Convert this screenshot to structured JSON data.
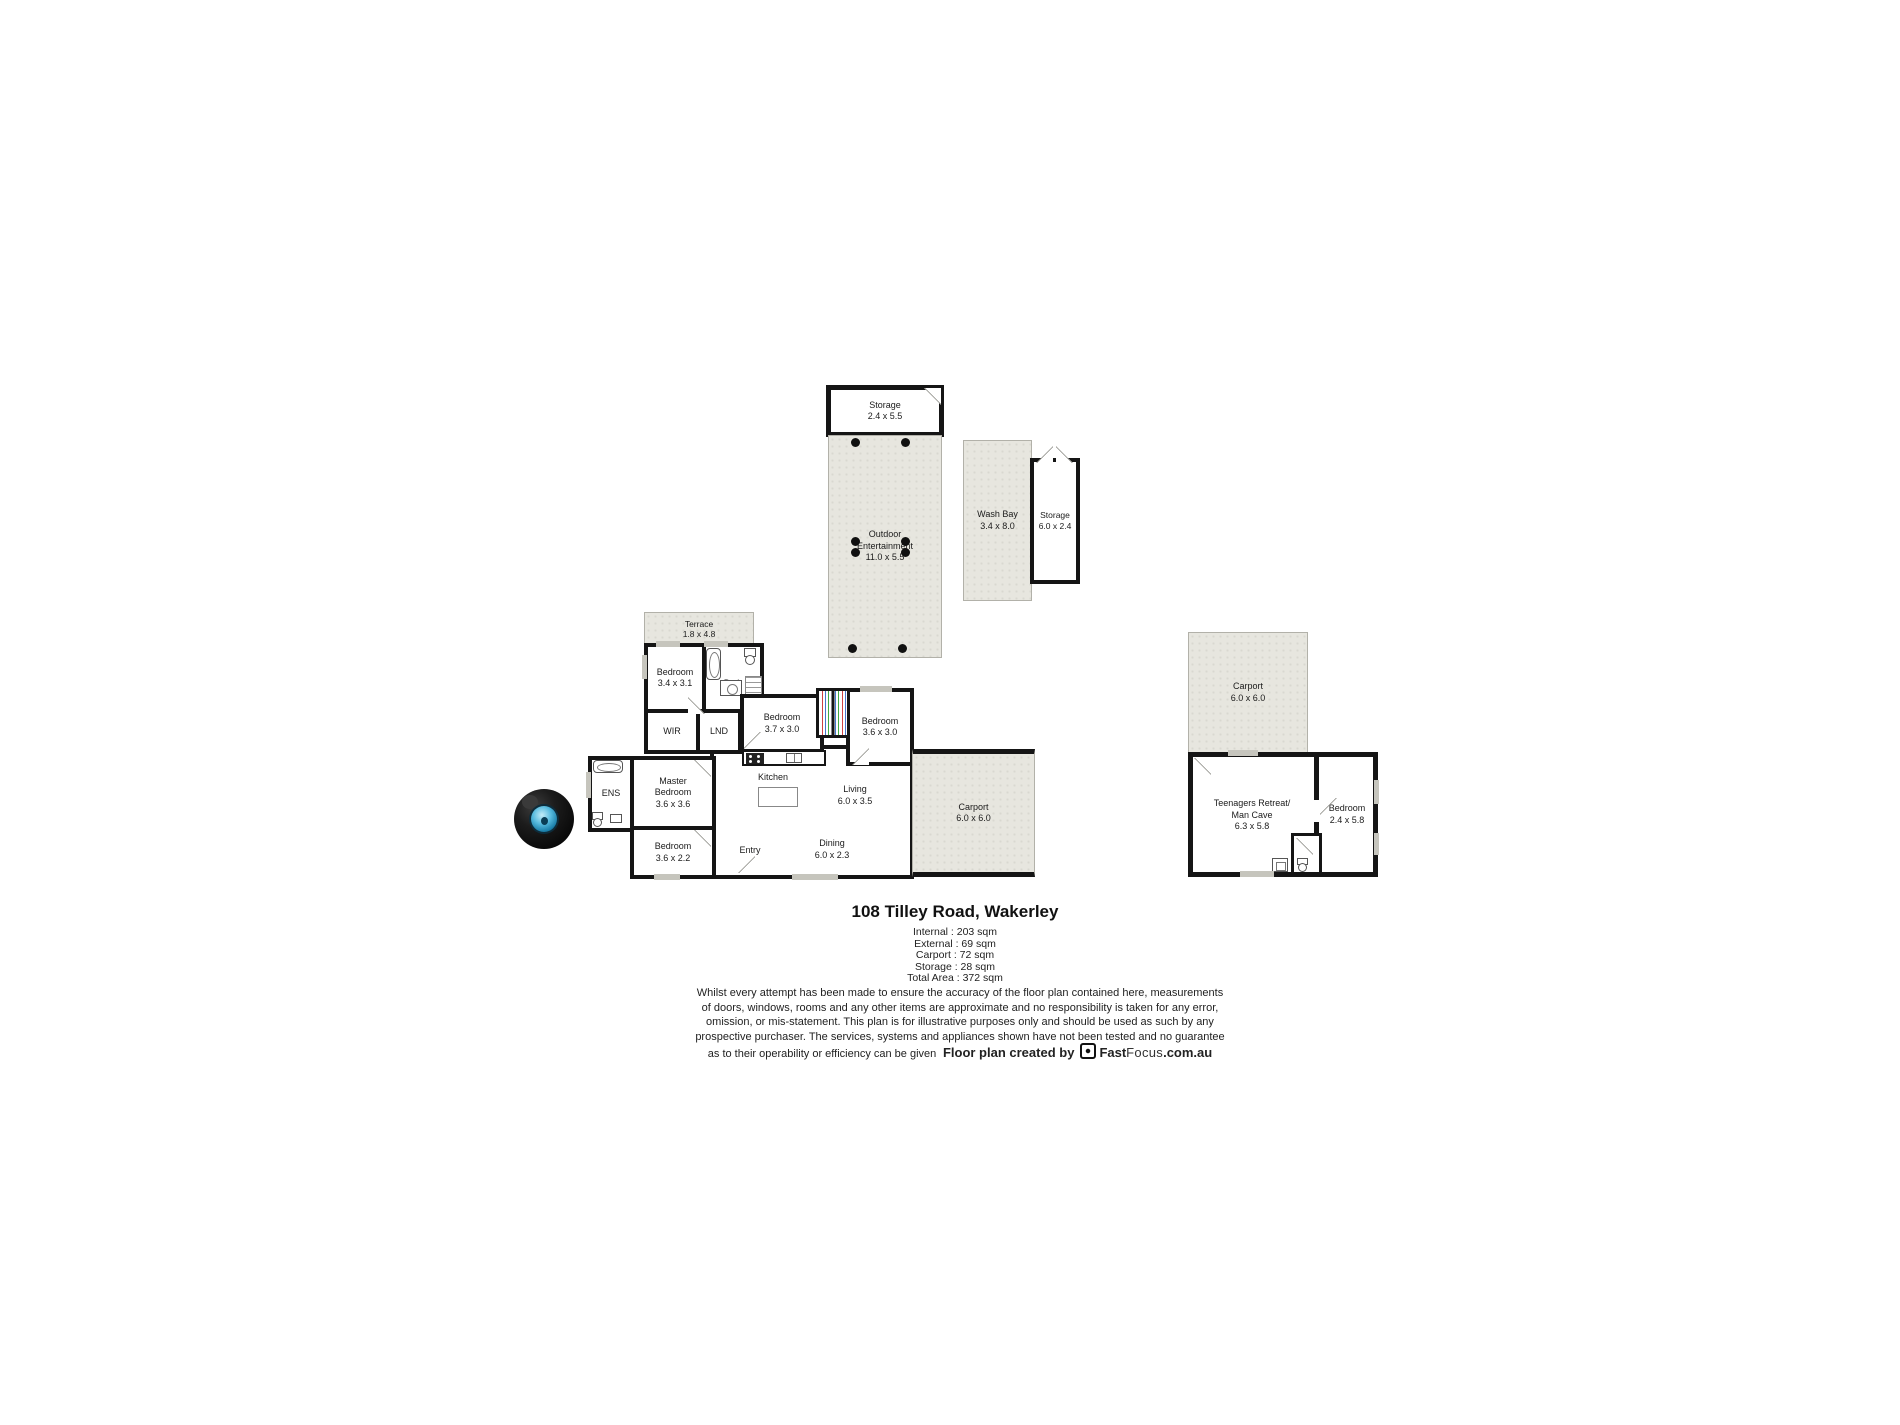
{
  "floorplan": {
    "rooms": {
      "storage_top": {
        "name": "Storage",
        "dims": "2.4 x 5.5"
      },
      "outdoor": {
        "line1": "Outdoor",
        "line2": "Entertainment",
        "dims": "11.0 x 5.5"
      },
      "wash_bay": {
        "name": "Wash Bay",
        "dims": "3.4 x 8.0"
      },
      "storage_shed": {
        "name": "Storage",
        "dims": "6.0 x 2.4"
      },
      "terrace": {
        "name": "Terrace",
        "dims": "1.8 x 4.8"
      },
      "bedroom_a": {
        "name": "Bedroom",
        "dims": "3.4 x 3.1"
      },
      "bath": {
        "name": "Bath"
      },
      "wir": {
        "name": "WIR"
      },
      "lnd": {
        "name": "LND"
      },
      "bedroom_b": {
        "name": "Bedroom",
        "dims": "3.7 x 3.0"
      },
      "bedroom_c": {
        "name": "Bedroom",
        "dims": "3.6 x 3.0"
      },
      "kitchen": {
        "name": "Kitchen"
      },
      "living": {
        "name": "Living",
        "dims": "6.0 x 3.5"
      },
      "master": {
        "line1": "Master",
        "line2": "Bedroom",
        "dims": "3.6 x 3.6"
      },
      "ens": {
        "name": "ENS"
      },
      "bedroom_d": {
        "name": "Bedroom",
        "dims": "3.6 x 2.2"
      },
      "entry": {
        "name": "Entry"
      },
      "dining": {
        "name": "Dining",
        "dims": "6.0 x 2.3"
      },
      "carport_house": {
        "name": "Carport",
        "dims": "6.0 x 6.0"
      },
      "carport_shed": {
        "name": "Carport",
        "dims": "6.0 x 6.0"
      },
      "retreat": {
        "line1": "Teenagers Retreat/",
        "line2": "Man Cave",
        "dims": "6.3 x 5.8"
      },
      "bedroom_e": {
        "name": "Bedroom",
        "dims": "2.4 x 5.8"
      }
    },
    "title": "108 Tilley Road, Wakerley",
    "areas": [
      "Internal : 203 sqm",
      "External : 69 sqm",
      "Carport : 72 sqm",
      "Storage : 28 sqm",
      "Total Area : 372 sqm"
    ],
    "disclaimer": {
      "line1": "Whilst every attempt has been made to ensure the accuracy of the floor plan contained here, measurements",
      "line2": "of doors, windows, rooms and any other items are approximate and no responsibility is taken for any error,",
      "line3": "omission, or mis-statement. This plan is for illustrative purposes only and should be used as such by any",
      "line4": "prospective purchaser. The services, systems and appliances shown have not been tested and no guarantee",
      "line5": "as to their operability or efficiency can be given"
    },
    "credit": {
      "prefix": "Floor plan created by",
      "brand_bold": "Fast",
      "brand_light": "Focus",
      "brand_suffix": ".com.au"
    },
    "colors": {
      "wall": "#151515",
      "area_fill": "#e7e6df",
      "window": "#c6c5bd",
      "lens_blue": "#56bade"
    }
  }
}
